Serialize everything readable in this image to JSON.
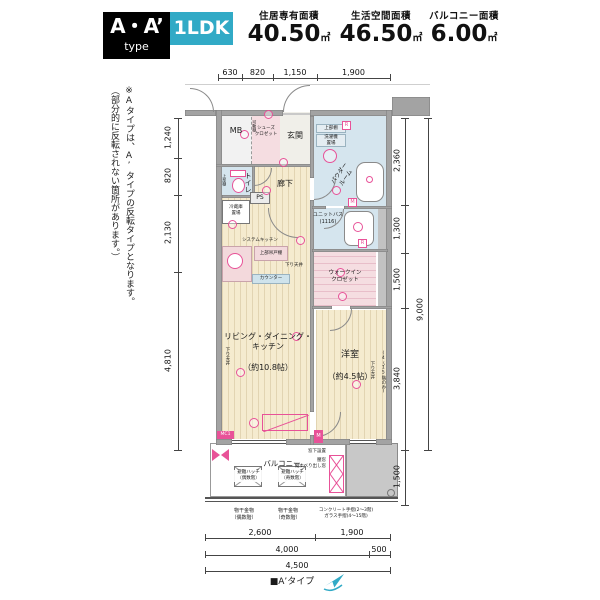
{
  "header": {
    "type_main": "A・A’",
    "type_sub": "type",
    "plan": "1LDK",
    "stats": [
      {
        "label": "住居専有面積",
        "value": "40.50",
        "unit": "㎡"
      },
      {
        "label": "生活空間面積",
        "value": "46.50",
        "unit": "㎡"
      },
      {
        "label": "バルコニー面積",
        "value": "6.00",
        "unit": "㎡"
      }
    ]
  },
  "side_note": {
    "line1": "※Aタイプは、A’タイプの反転タイプとなります。",
    "line2": "（部分的に反転されない箇所があります。）"
  },
  "rooms": {
    "mb": "MB",
    "shoes_closet": "シューズ\nクロゼット",
    "movable_shelf": "可動棚",
    "entrance": "玄関",
    "hallway": "廊下",
    "toilet": "トイレ",
    "upper_shelf_toilet": "上部棚",
    "upper_shelf": "上部棚",
    "washer": "洗濯機\n置場",
    "powder_room": "パウダー\nルーム",
    "unit_bath": "ユニットバス\n(1116)",
    "fridge": "冷蔵庫\n置場",
    "ps": "PS",
    "system_kitchen": "システムキッチン",
    "hanging_cupboard": "上部吊戸棚",
    "counter": "カウンター",
    "walk_in_closet": "ウォークイン\nクロゼット",
    "ldk": "リビング・ダイニング・\nキッチン",
    "ldk_size": "（約10.8帖）",
    "bedroom": "洋室",
    "bedroom_size": "（約4.5帖）",
    "balcony": "バルコニー",
    "dropped_ceiling": "下り天井"
  },
  "plan_notes": {
    "hatch_even": "避難ハッチ\n（偶数階）",
    "hatch_odd": "避難ハッチ\n（奇数階）",
    "pole_even": "物干金物\n（偶数階）",
    "pole_odd": "物干金物\n（奇数階）",
    "handrail": "コンクリート手摺(2〜3階)\nガラス手摺(4〜15階)",
    "under_window": "窓下設置",
    "window_type": "腰窓\n縦すべり出し窓",
    "floors_only": "(4〜15階のみ)",
    "mc1": "MC1",
    "m": "M",
    "r": "R"
  },
  "dimensions": {
    "top": [
      "630",
      "820",
      "1,150",
      "1,900"
    ],
    "left": [
      "1,240",
      "820",
      "2,130",
      "4,810"
    ],
    "right": [
      "2,360",
      "1,300",
      "1,500",
      "3,840",
      "1,500"
    ],
    "right_total": "9,000",
    "bottom1": [
      "2,600",
      "1,900"
    ],
    "bottom2": [
      "4,000",
      "500"
    ],
    "bottom3": "4,500"
  },
  "footer": {
    "legend": "■A’タイプ"
  },
  "colors": {
    "accent_teal": "#31aac6",
    "pink": "#e85298",
    "wood": "#f5ebcf",
    "room_blue": "#d5e5ee",
    "room_pink": "#f5dde1",
    "wall_gray": "#a3a3a3"
  }
}
